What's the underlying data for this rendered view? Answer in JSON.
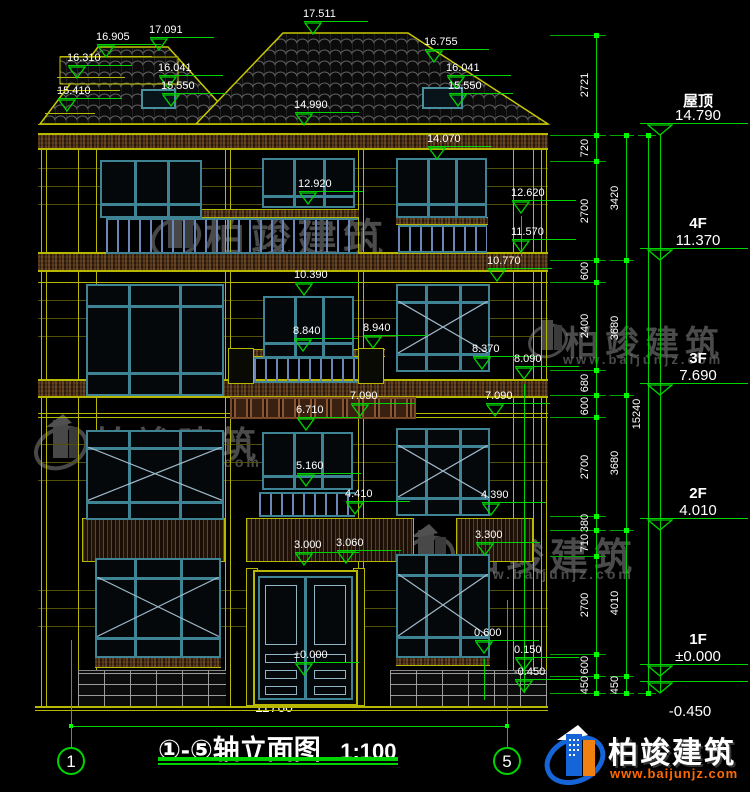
{
  "title": {
    "axis_range": "①-⑤",
    "name": "轴立面图",
    "scale": "1:100"
  },
  "bottom_dim": {
    "label": "11760"
  },
  "axis_bubbles": [
    {
      "label": "1",
      "x": 71
    },
    {
      "label": "5",
      "x": 507
    }
  ],
  "watermark": {
    "name": "柏竣建筑",
    "url": "www.baijunjz.com"
  },
  "logo": {
    "name": "柏竣建筑",
    "url": "www.baijunjz.com"
  },
  "floor_levels": [
    {
      "name": "屋顶",
      "value": "14.790",
      "y": 135
    },
    {
      "name": "4F",
      "value": "11.370",
      "y": 260
    },
    {
      "name": "3F",
      "value": "7.690",
      "y": 395
    },
    {
      "name": "2F",
      "value": "4.010",
      "y": 530
    },
    {
      "name": "1F",
      "value": "±0.000",
      "y": 676
    },
    {
      "name": "",
      "value": "-0.450",
      "y": 693
    }
  ],
  "dim_chains": [
    {
      "x": 596,
      "tick_x": 550,
      "tick_w": 56,
      "boundaries": [
        35,
        135,
        161,
        260,
        282,
        370,
        395,
        417,
        516,
        530,
        556,
        654,
        676,
        693
      ],
      "labels": [
        "2721",
        "720",
        "2700",
        "600",
        "2400",
        "680",
        "600",
        "2700",
        "380",
        "710",
        "2700",
        "600",
        "450"
      ]
    },
    {
      "x": 626,
      "tick_x": 610,
      "tick_w": 24,
      "boundaries": [
        135,
        260,
        395,
        530,
        676,
        693
      ],
      "labels": [
        "3420",
        "3680",
        "3680",
        "4010",
        "450"
      ]
    },
    {
      "x": 648,
      "tick_x": 638,
      "tick_w": 18,
      "boundaries": [
        135,
        693
      ],
      "labels": [
        "15240"
      ]
    }
  ],
  "elev_markers": [
    {
      "label": "17.511",
      "x": 313,
      "y": 35
    },
    {
      "label": "16.905",
      "x": 106,
      "y": 58
    },
    {
      "label": "17.091",
      "x": 159,
      "y": 51
    },
    {
      "label": "16.310",
      "x": 77,
      "y": 79
    },
    {
      "label": "15.410",
      "x": 67,
      "y": 112
    },
    {
      "label": "16.041",
      "x": 168,
      "y": 89
    },
    {
      "label": "15.550",
      "x": 171,
      "y": 107
    },
    {
      "label": "16.755",
      "x": 434,
      "y": 63
    },
    {
      "label": "16.041",
      "x": 456,
      "y": 89
    },
    {
      "label": "15.550",
      "x": 458,
      "y": 107
    },
    {
      "label": "14.990",
      "x": 304,
      "y": 126
    },
    {
      "label": "14.070",
      "x": 437,
      "y": 160
    },
    {
      "label": "12.920",
      "x": 308,
      "y": 205
    },
    {
      "label": "12.620",
      "x": 521,
      "y": 214
    },
    {
      "label": "11.570",
      "x": 521,
      "y": 253
    },
    {
      "label": "10.770",
      "x": 497,
      "y": 282
    },
    {
      "label": "10.390",
      "x": 304,
      "y": 296
    },
    {
      "label": "8.840",
      "x": 303,
      "y": 352
    },
    {
      "label": "8.940",
      "x": 373,
      "y": 349
    },
    {
      "label": "8.370",
      "x": 482,
      "y": 370
    },
    {
      "label": "8.090",
      "x": 524,
      "y": 380
    },
    {
      "label": "7.090",
      "x": 360,
      "y": 417
    },
    {
      "label": "6.710",
      "x": 306,
      "y": 431
    },
    {
      "label": "7.090",
      "x": 495,
      "y": 417
    },
    {
      "label": "5.160",
      "x": 306,
      "y": 487
    },
    {
      "label": "4.410",
      "x": 355,
      "y": 515
    },
    {
      "label": "4.390",
      "x": 491,
      "y": 516
    },
    {
      "label": "3.300",
      "x": 485,
      "y": 556
    },
    {
      "label": "3.000",
      "x": 304,
      "y": 566
    },
    {
      "label": "3.060",
      "x": 346,
      "y": 564
    },
    {
      "label": "0.600",
      "x": 484,
      "y": 654
    },
    {
      "label": "0.150",
      "x": 524,
      "y": 671
    },
    {
      "label": "±0.000",
      "x": 304,
      "y": 676
    },
    {
      "label": "-0.450",
      "x": 524,
      "y": 693
    }
  ],
  "drawing": {
    "windows": [
      {
        "x": 100,
        "y": 160,
        "w": 102,
        "h": 58,
        "t": "g"
      },
      {
        "x": 262,
        "y": 158,
        "w": 93,
        "h": 50,
        "t": "g"
      },
      {
        "x": 396,
        "y": 158,
        "w": 91,
        "h": 60,
        "t": "g"
      },
      {
        "x": 86,
        "y": 284,
        "w": 138,
        "h": 112,
        "t": "b"
      },
      {
        "x": 263,
        "y": 296,
        "w": 91,
        "h": 62,
        "t": "g"
      },
      {
        "x": 396,
        "y": 284,
        "w": 94,
        "h": 88,
        "t": "bx"
      },
      {
        "x": 86,
        "y": 430,
        "w": 138,
        "h": 90,
        "t": "bx"
      },
      {
        "x": 262,
        "y": 432,
        "w": 91,
        "h": 58,
        "t": "g"
      },
      {
        "x": 396,
        "y": 428,
        "w": 94,
        "h": 88,
        "t": "bx"
      },
      {
        "x": 95,
        "y": 558,
        "w": 126,
        "h": 100,
        "t": "bx"
      },
      {
        "x": 396,
        "y": 554,
        "w": 94,
        "h": 104,
        "t": "bx"
      }
    ],
    "railings": [
      [
        106,
        218,
        252,
        36
      ],
      [
        398,
        225,
        89,
        28
      ],
      [
        232,
        357,
        152,
        26
      ],
      [
        259,
        492,
        96,
        25
      ]
    ],
    "caps": [
      [
        106,
        209,
        253,
        9
      ],
      [
        396,
        217,
        92,
        8
      ],
      [
        232,
        349,
        153,
        8
      ]
    ],
    "posts": [
      [
        228,
        348,
        26,
        36
      ],
      [
        358,
        348,
        26,
        36
      ],
      [
        246,
        568,
        12,
        138
      ],
      [
        353,
        568,
        12,
        138
      ]
    ],
    "panels": [
      [
        82,
        518,
        143,
        44
      ],
      [
        246,
        518,
        168,
        44
      ],
      [
        456,
        518,
        77,
        44
      ]
    ],
    "bands": [
      [
        38,
        134,
        510,
        15
      ],
      [
        38,
        253,
        510,
        18
      ],
      [
        38,
        380,
        510,
        17
      ]
    ],
    "sills": [
      [
        95,
        656,
        126,
        12
      ],
      [
        396,
        654,
        94,
        12
      ]
    ],
    "bricks": [
      [
        78,
        670,
        148,
        36
      ],
      [
        390,
        670,
        157,
        36
      ]
    ],
    "frieze": [
      230,
      397,
      186,
      22
    ],
    "door": [
      253,
      570,
      105,
      136
    ],
    "yellow_lines": [
      [
        78,
        150,
        1,
        556
      ],
      [
        96,
        150,
        1,
        556
      ],
      [
        225,
        150,
        1,
        556
      ],
      [
        230,
        150,
        1,
        556
      ],
      [
        358,
        150,
        1,
        556
      ],
      [
        363,
        150,
        1,
        556
      ],
      [
        513,
        150,
        1,
        556
      ],
      [
        533,
        150,
        1,
        556
      ],
      [
        41,
        150,
        1,
        556
      ],
      [
        46,
        150,
        1,
        556
      ],
      [
        541,
        150,
        1,
        556
      ],
      [
        546,
        150,
        1,
        556
      ],
      [
        35,
        706,
        513,
        2
      ],
      [
        35,
        710,
        513,
        1
      ],
      [
        38,
        124,
        510,
        1
      ],
      [
        38,
        133,
        510,
        1
      ],
      [
        38,
        149,
        510,
        1
      ],
      [
        38,
        252,
        510,
        1
      ],
      [
        38,
        271,
        510,
        1
      ],
      [
        38,
        282,
        510,
        1
      ],
      [
        38,
        379,
        510,
        1
      ],
      [
        38,
        397,
        510,
        1
      ],
      [
        38,
        413,
        510,
        1
      ],
      [
        38,
        417,
        510,
        1
      ],
      [
        60,
        56,
        92,
        1
      ],
      [
        57,
        77,
        68,
        1
      ],
      [
        57,
        90,
        63,
        1
      ],
      [
        45,
        113,
        50,
        1
      ],
      [
        95,
        654,
        126,
        1
      ],
      [
        396,
        652,
        94,
        1
      ]
    ],
    "dark_lines": [
      [
        38,
        168,
        510,
        1
      ],
      [
        38,
        186,
        510,
        1
      ],
      [
        38,
        204,
        510,
        1
      ],
      [
        38,
        300,
        510,
        1
      ],
      [
        38,
        318,
        510,
        1
      ],
      [
        38,
        336,
        510,
        1
      ],
      [
        38,
        444,
        510,
        1
      ],
      [
        38,
        462,
        510,
        1
      ],
      [
        38,
        480,
        510,
        1
      ],
      [
        38,
        590,
        510,
        1
      ],
      [
        38,
        608,
        510,
        1
      ],
      [
        38,
        626,
        510,
        1
      ]
    ],
    "green_lines": [
      [
        71,
        726,
        437,
        1
      ],
      [
        71,
        640,
        1,
        108
      ],
      [
        507,
        600,
        1,
        148
      ],
      [
        521,
        216,
        1,
        40
      ],
      [
        524,
        384,
        1,
        309
      ],
      [
        484,
        659,
        1,
        41
      ],
      [
        158,
        757,
        240,
        4
      ],
      [
        158,
        763,
        240,
        2
      ]
    ],
    "green_dots": [
      [
        69,
        724
      ],
      [
        505,
        724
      ]
    ]
  },
  "colors": {
    "line_yellow": "#b8b800",
    "line_green": "#00d400",
    "window_teal": "#3f8494",
    "logo_blue": "#1565d8",
    "logo_orange": "#f08010",
    "url_orange": "#ff6a00"
  }
}
